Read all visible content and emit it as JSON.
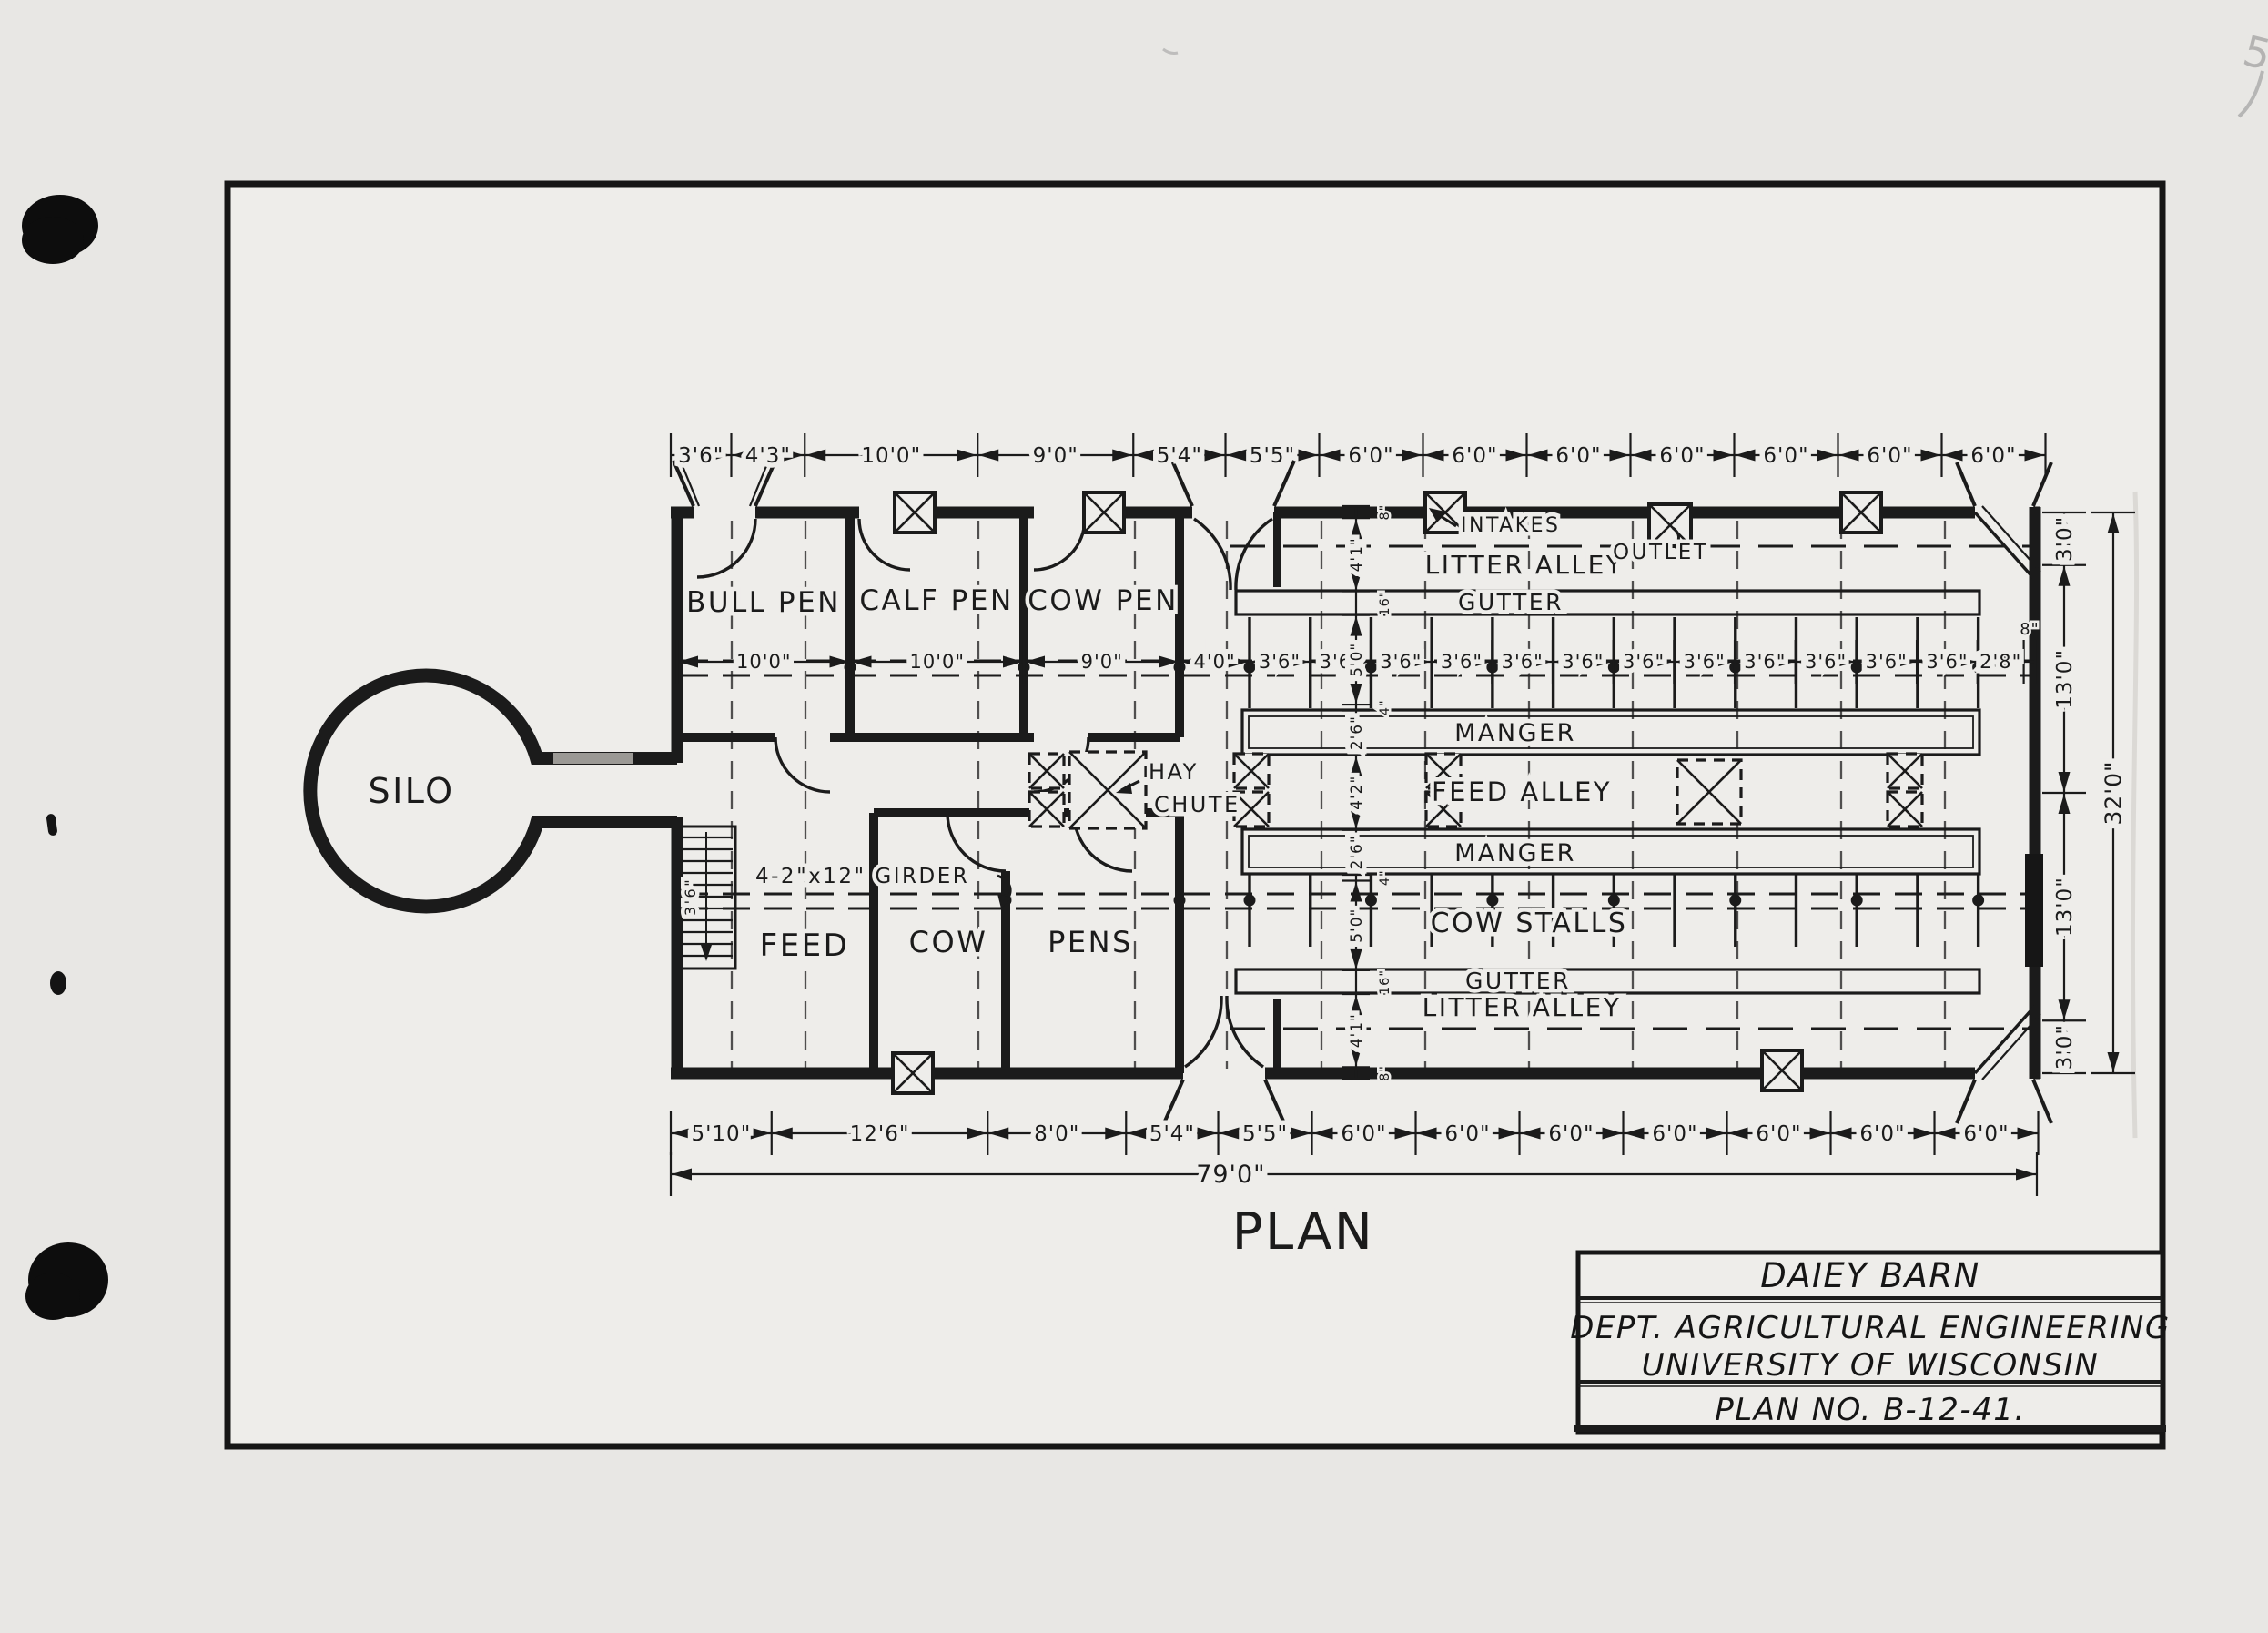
{
  "document": {
    "caption": "PLAN",
    "pencil_mark": "5"
  },
  "title_block": {
    "title": "DAIEY BARN",
    "department": "DEPT. AGRICULTURAL ENGINEERING",
    "institution": "UNIVERSITY OF WISCONSIN",
    "plan_no": "PLAN NO. B-12-41."
  },
  "rooms": {
    "silo": "SILO",
    "bull_pen": "BULL PEN",
    "calf_pen": "CALF PEN",
    "cow_pen": "COW PEN",
    "feed": "FEED",
    "cow_pens_left": "COW",
    "cow_pens_right": "PENS"
  },
  "areas": {
    "litter_alley_top": "LITTER ALLEY",
    "gutter_top": "GUTTER",
    "manger_top": "MANGER",
    "feed_alley": "FEED ALLEY",
    "manger_bottom": "MANGER",
    "cow_stalls": "COW STALLS",
    "gutter_bottom": "GUTTER",
    "litter_alley_bottom": "LITTER ALLEY"
  },
  "annotations": {
    "intakes": "INTAKES",
    "outlet": "OUTLET",
    "hay_line1": "HAY",
    "hay_line2": "CHUTE",
    "girder": "4-2\"x12\" GIRDER",
    "stair_width": "3'6\""
  },
  "dimensions": {
    "top_chain": {
      "segments": [
        {
          "label": "3'6\"",
          "ft": 3.5
        },
        {
          "label": "4'3\"",
          "ft": 4.25
        },
        {
          "label": "10'0\"",
          "ft": 10
        },
        {
          "label": "9'0\"",
          "ft": 9
        },
        {
          "label": "5'4\"",
          "ft": 5.33
        },
        {
          "label": "5'5\"",
          "ft": 5.42
        },
        {
          "label": "6'0\"",
          "ft": 6
        },
        {
          "label": "6'0\"",
          "ft": 6
        },
        {
          "label": "6'0\"",
          "ft": 6
        },
        {
          "label": "6'0\"",
          "ft": 6
        },
        {
          "label": "6'0\"",
          "ft": 6
        },
        {
          "label": "6'0\"",
          "ft": 6
        },
        {
          "label": "6'0\"",
          "ft": 6
        }
      ]
    },
    "bottom_chain": {
      "segments": [
        {
          "label": "5'10\"",
          "ft": 5.83
        },
        {
          "label": "12'6\"",
          "ft": 12.5
        },
        {
          "label": "8'0\"",
          "ft": 8
        },
        {
          "label": "5'4\"",
          "ft": 5.33
        },
        {
          "label": "5'5\"",
          "ft": 5.42
        },
        {
          "label": "6'0\"",
          "ft": 6
        },
        {
          "label": "6'0\"",
          "ft": 6
        },
        {
          "label": "6'0\"",
          "ft": 6
        },
        {
          "label": "6'0\"",
          "ft": 6
        },
        {
          "label": "6'0\"",
          "ft": 6
        },
        {
          "label": "6'0\"",
          "ft": 6
        },
        {
          "label": "6'0\"",
          "ft": 6
        }
      ]
    },
    "interior_chain": {
      "segments": [
        {
          "label": "10'0\"",
          "ft": 10
        },
        {
          "label": "10'0\"",
          "ft": 10
        },
        {
          "label": "9'0\"",
          "ft": 9
        },
        {
          "label": "4'0\"",
          "ft": 4
        },
        {
          "label": "3'6\"",
          "ft": 3.5
        },
        {
          "label": "3'6\"",
          "ft": 3.5
        },
        {
          "label": "3'6\"",
          "ft": 3.5
        },
        {
          "label": "3'6\"",
          "ft": 3.5
        },
        {
          "label": "3'6\"",
          "ft": 3.5
        },
        {
          "label": "3'6\"",
          "ft": 3.5
        },
        {
          "label": "3'6\"",
          "ft": 3.5
        },
        {
          "label": "3'6\"",
          "ft": 3.5
        },
        {
          "label": "3'6\"",
          "ft": 3.5
        },
        {
          "label": "3'6\"",
          "ft": 3.5
        },
        {
          "label": "3'6\"",
          "ft": 3.5
        },
        {
          "label": "3'6\"",
          "ft": 3.5
        },
        {
          "label": "2'8\"",
          "ft": 2.67
        },
        {
          "label": "8\"",
          "ft": 0.67
        }
      ]
    },
    "right_chain": {
      "segments": [
        {
          "label": "3'0\"",
          "ft": 3
        },
        {
          "label": "13'0\"",
          "ft": 13
        },
        {
          "label": "13'0\"",
          "ft": 13
        },
        {
          "label": "3'0\"",
          "ft": 3
        }
      ]
    },
    "center_chain": {
      "segments": [
        {
          "label": "8\"",
          "ft": 0.67
        },
        {
          "label": "4'1\"",
          "ft": 4.08
        },
        {
          "label": "16\"",
          "ft": 1.33
        },
        {
          "label": "5'0\"",
          "ft": 5
        },
        {
          "label": "4\"",
          "ft": 0.33
        },
        {
          "label": "2'6\"",
          "ft": 2.5
        },
        {
          "label": "4'2\"",
          "ft": 4.17
        },
        {
          "label": "2'6\"",
          "ft": 2.5
        },
        {
          "label": "4\"",
          "ft": 0.33
        },
        {
          "label": "5'0\"",
          "ft": 5
        },
        {
          "label": "16\"",
          "ft": 1.33
        },
        {
          "label": "4'1\"",
          "ft": 4.08
        },
        {
          "label": "8\"",
          "ft": 0.67
        }
      ]
    },
    "overall_width": {
      "segments": [
        {
          "label": "79'0\"",
          "ft": 79
        }
      ]
    },
    "overall_depth": {
      "segments": [
        {
          "label": "32'0\"",
          "ft": 32
        }
      ]
    }
  }
}
